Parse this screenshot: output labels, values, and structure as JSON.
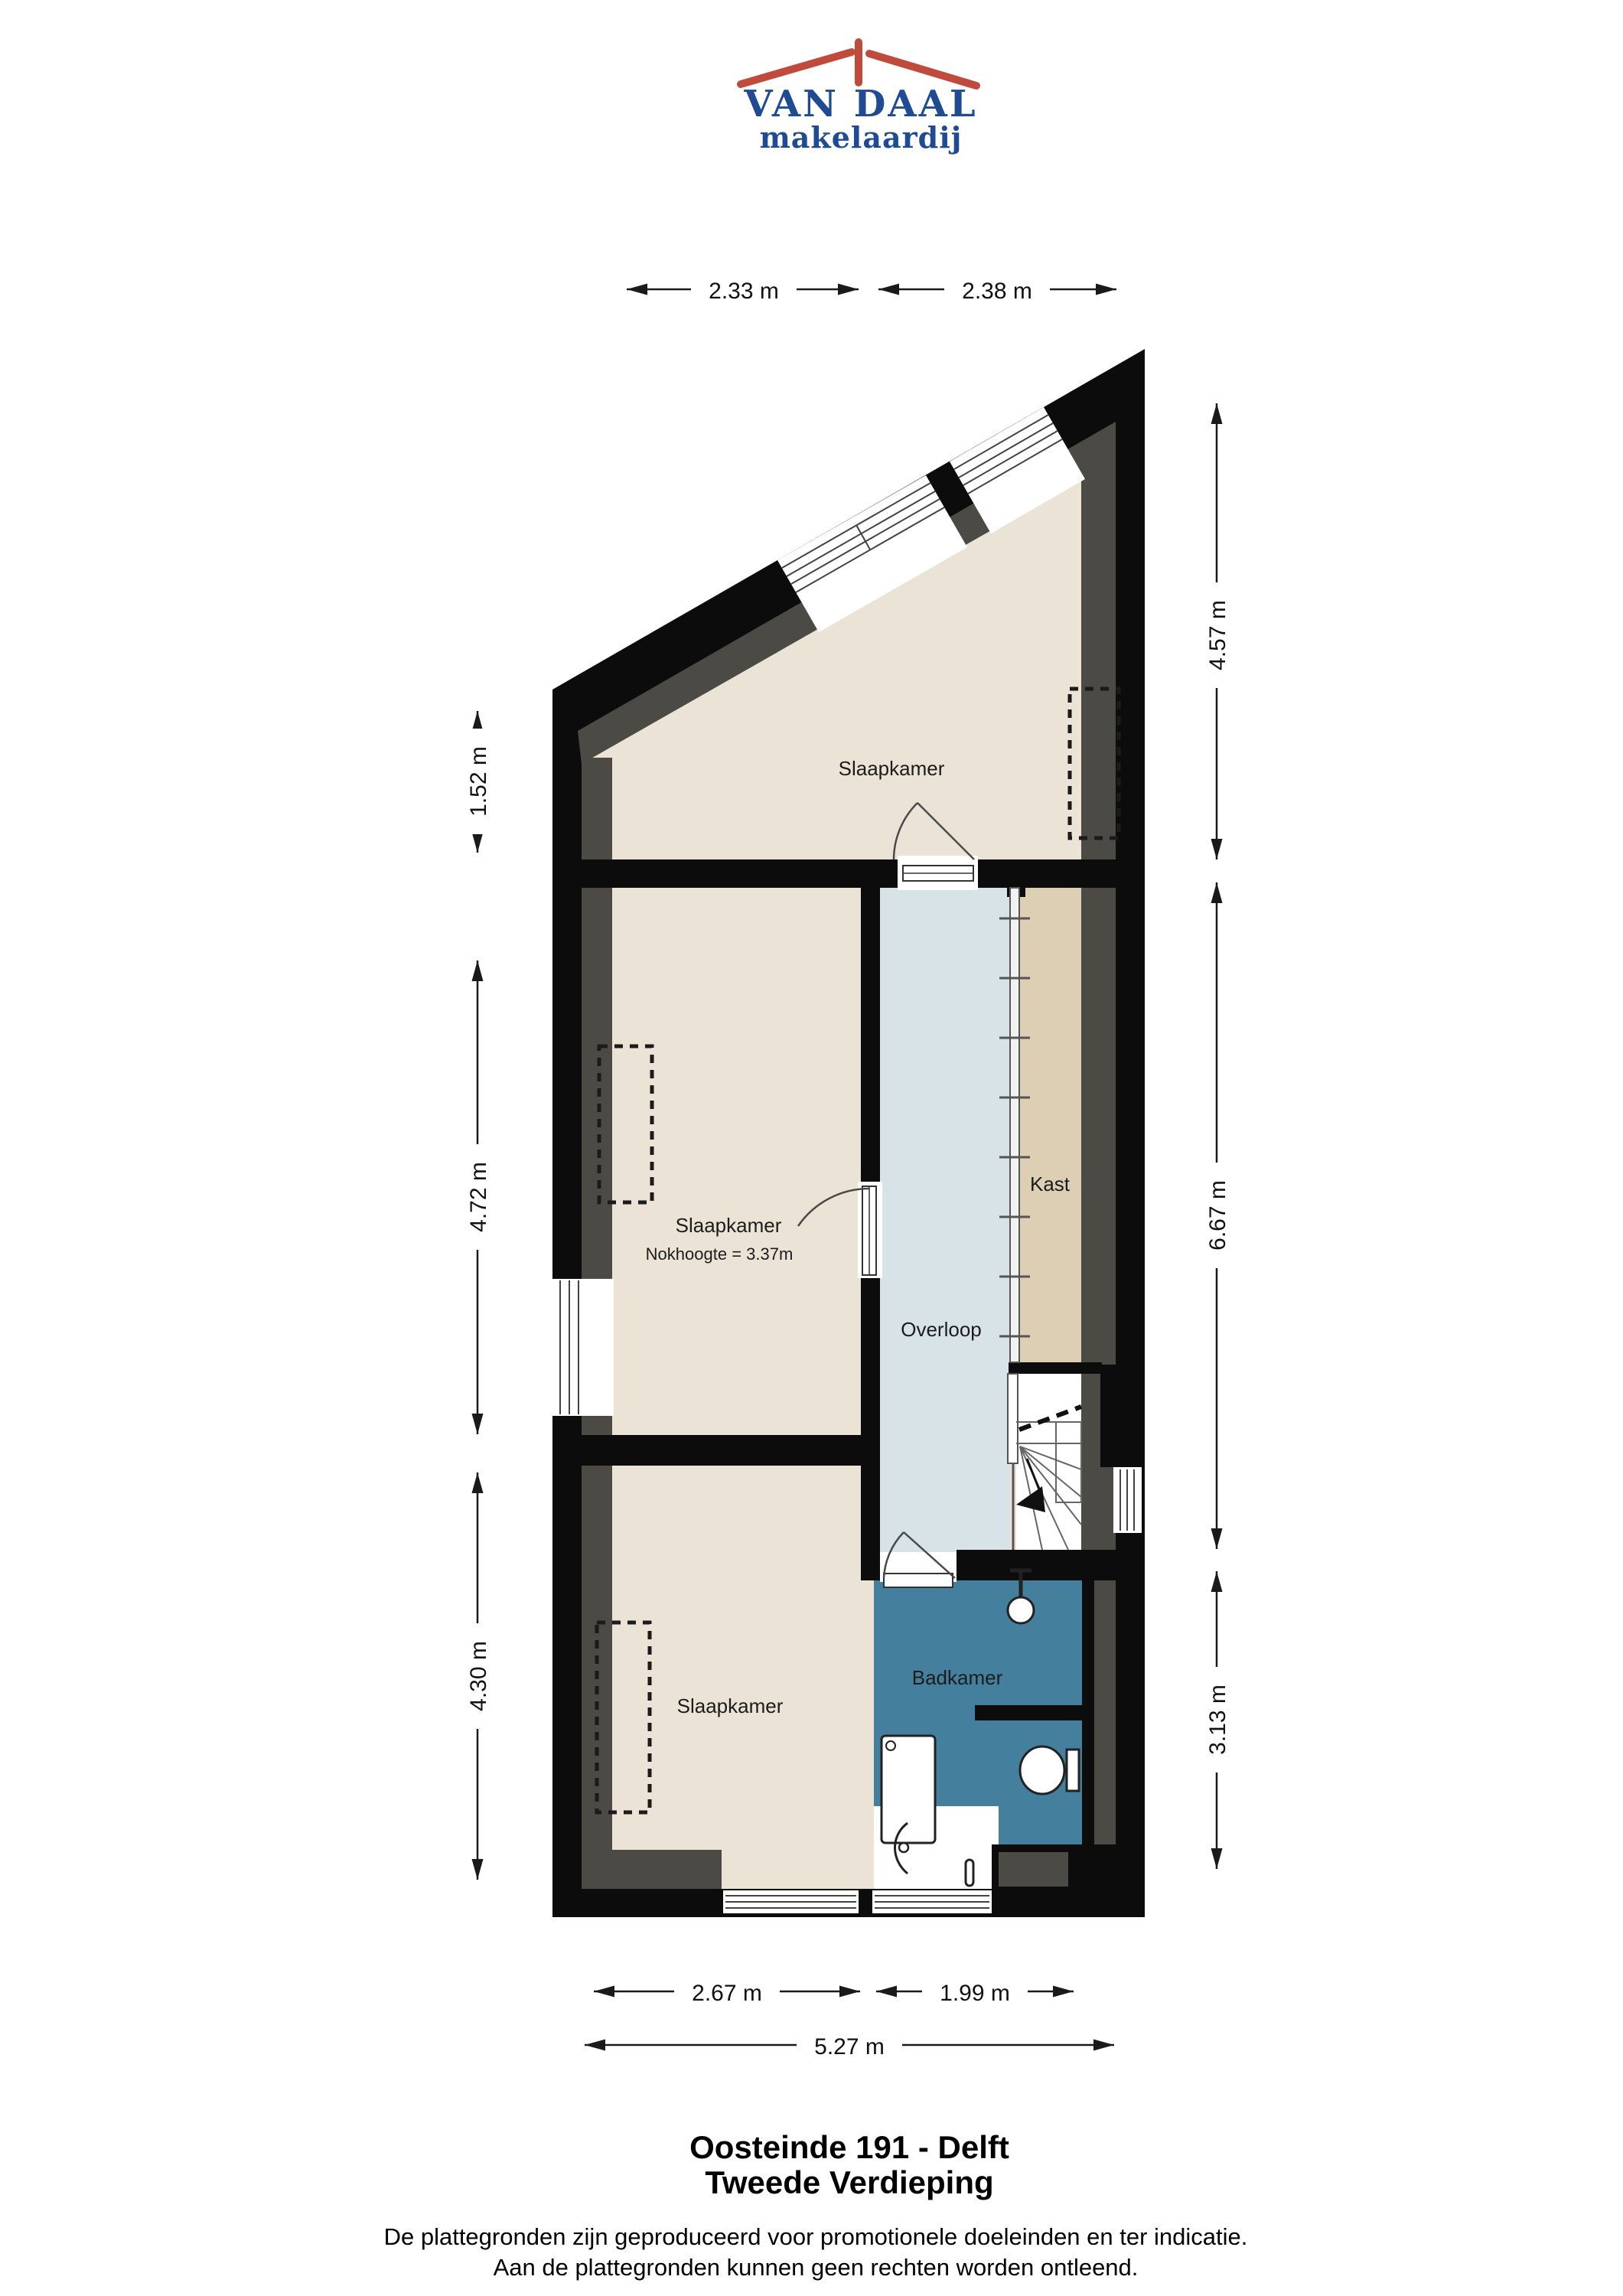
{
  "logo": {
    "name": "VAN DAAL",
    "tagline": "makelaardij",
    "blue": "#1e4b94",
    "red": "#c04b3d"
  },
  "plan": {
    "rooms": {
      "bedroom_top": {
        "label": "Slaapkamer"
      },
      "bedroom_middle": {
        "label": "Slaapkamer",
        "note": "Nokhoogte = 3.37m"
      },
      "bedroom_bottom": {
        "label": "Slaapkamer"
      },
      "landing": {
        "label": "Overloop"
      },
      "closet": {
        "label": "Kast"
      },
      "bathroom": {
        "label": "Badkamer"
      }
    },
    "dimensions": {
      "top": [
        "2.33 m",
        "2.38 m"
      ],
      "left": [
        "1.52 m",
        "4.72 m",
        "4.30 m"
      ],
      "right": [
        "4.57 m",
        "6.67 m",
        "3.13 m"
      ],
      "bottom": [
        "2.67 m",
        "1.99 m",
        "5.27 m"
      ]
    }
  },
  "colors": {
    "wall": "#0c0c0c",
    "floor": "#ebe3d6",
    "slope_band": "#4c4a45",
    "closet_floor": "#dccfb4",
    "landing_floor": "#d7e3e6",
    "bathroom_floor": "#44809e"
  },
  "footer": {
    "address": "Oosteinde 191 - Delft",
    "floor": "Tweede Verdieping",
    "disclaimer_line1": "De plattegronden zijn geproduceerd voor promotionele doeleinden en ter indicatie.",
    "disclaimer_line2": "Aan de plattegronden kunnen geen rechten worden ontleend."
  }
}
